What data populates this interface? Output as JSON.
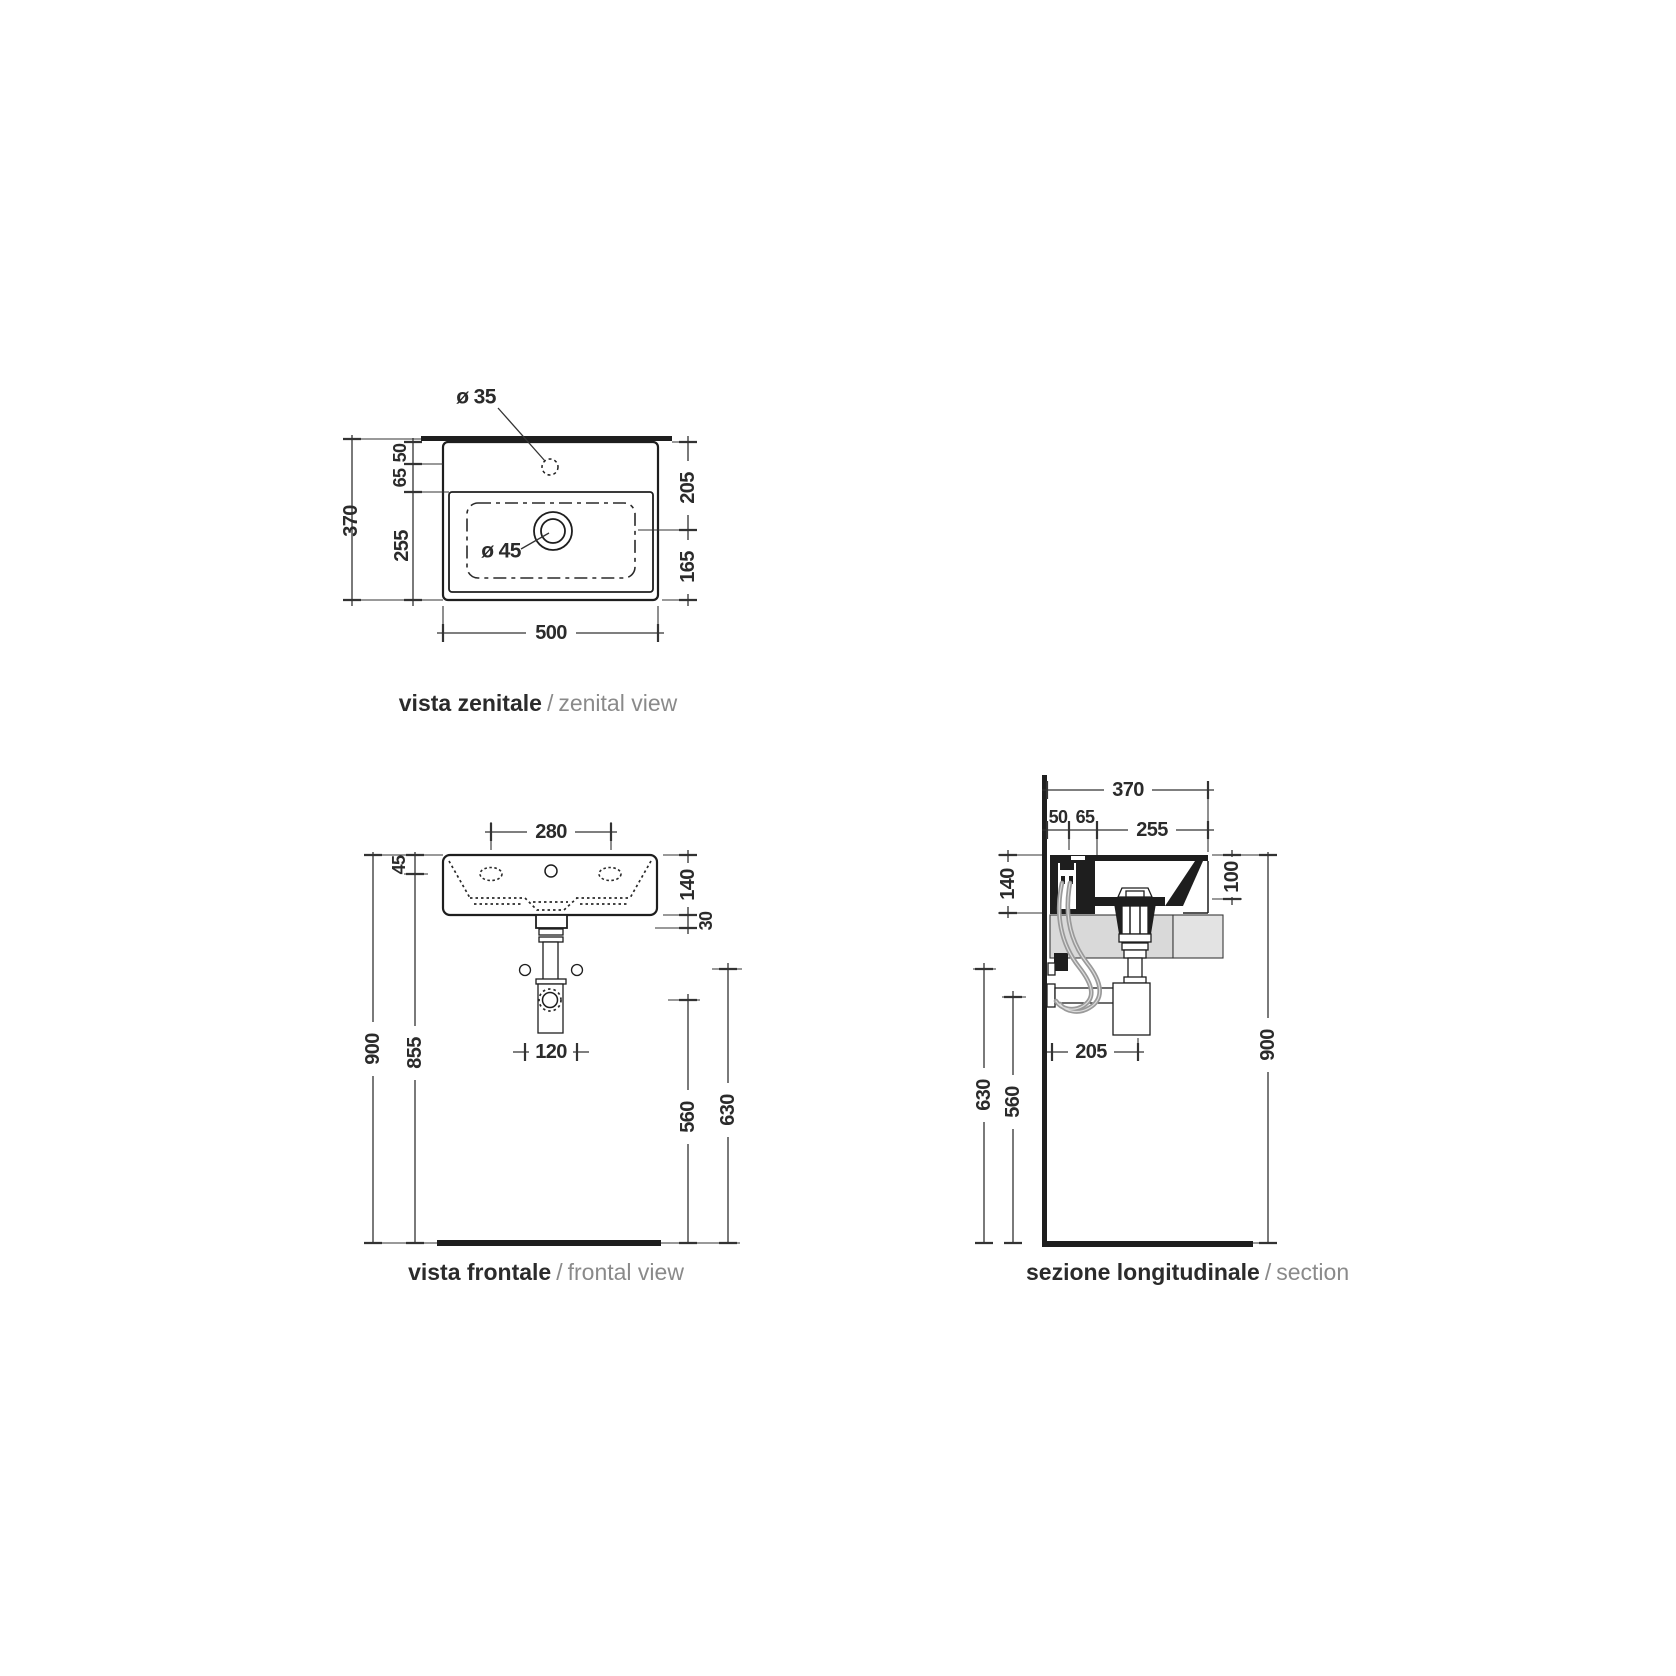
{
  "title_separator": "/",
  "colors": {
    "line": "#1e1e1e",
    "dim": "#333333",
    "hose": "#9a9a9a",
    "cabinet_fill": "#d9d9d9",
    "cabinet_fill_light": "#e3e3e3",
    "title_accent": "#2b2b2b",
    "title_muted": "#8a8a8a"
  },
  "views": {
    "zenital": {
      "title_it": "vista zenitale",
      "title_en": "zenital view",
      "dim_depth": "370",
      "dim_back_50": "50",
      "dim_back_65": "65",
      "dim_bowl_255": "255",
      "dim_front_205": "205",
      "dim_front_165": "165",
      "dim_width": "500",
      "label_faucet_hole": "ø 35",
      "label_drain_hole": "ø 45"
    },
    "frontal": {
      "title_it": "vista frontale",
      "title_en": "frontal view",
      "dim_faucet_spacing": "280",
      "dim_rim": "45",
      "dim_height_total": "900",
      "dim_height_rim": "855",
      "dim_basin_height": "140",
      "dim_drain_offset": "30",
      "dim_height_drain": "630",
      "dim_height_trap": "560",
      "dim_fixing_spacing": "120"
    },
    "section": {
      "title_it": "sezione longitudinale",
      "title_en": "section",
      "dim_depth": "370",
      "dim_back_50": "50",
      "dim_back_65": "65",
      "dim_bowl_255": "255",
      "dim_basin_height": "140",
      "dim_bowl_depth": "100",
      "dim_height_total": "900",
      "dim_height_valve": "630",
      "dim_height_pipe": "560",
      "dim_trap_offset": "205"
    }
  }
}
